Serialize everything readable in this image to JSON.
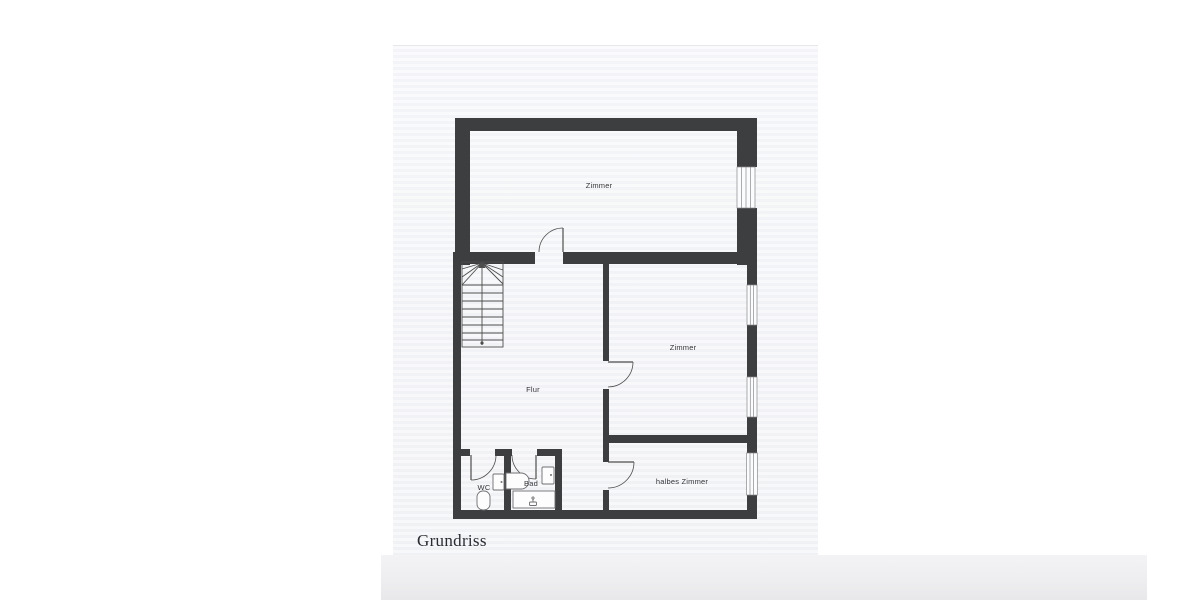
{
  "page": {
    "caption": "Grundriss",
    "background": "#ffffff",
    "paper_color": "#f5f6f8"
  },
  "plan": {
    "rooms": [
      {
        "id": "zimmer-top",
        "label": "Zimmer"
      },
      {
        "id": "zimmer-middle",
        "label": "Zimmer"
      },
      {
        "id": "flur",
        "label": "Flur"
      },
      {
        "id": "halbes-zimmer",
        "label": "halbes Zimmer"
      },
      {
        "id": "wc",
        "label": "WC"
      },
      {
        "id": "bad",
        "label": "Bad"
      }
    ],
    "colors": {
      "wall": "#3d3e40",
      "line": "#4d4d4d",
      "fixture": "#6e6e72",
      "window": "#8a8a8e",
      "label": "#36363a"
    }
  }
}
